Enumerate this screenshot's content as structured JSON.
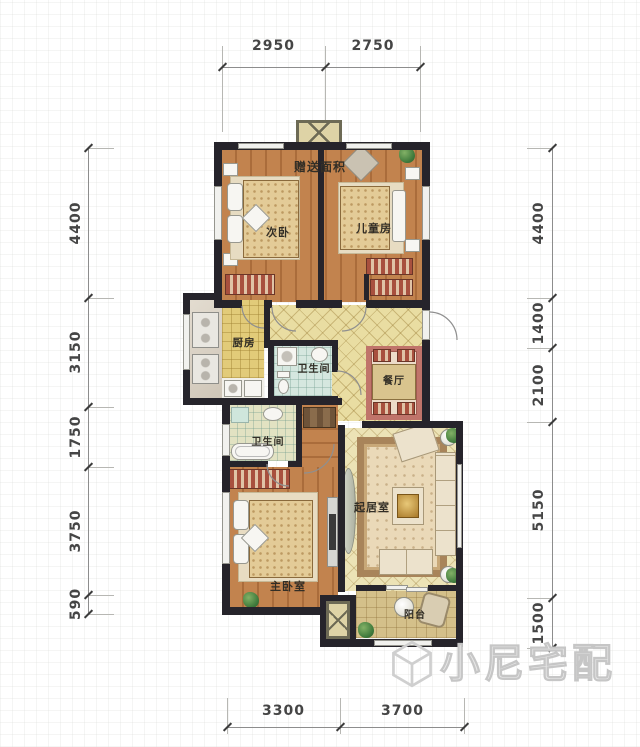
{
  "dimensions": {
    "top": [
      "2950",
      "2750"
    ],
    "bottom": [
      "3300",
      "3700"
    ],
    "left": [
      "4400",
      "3150",
      "1750",
      "3750",
      "590"
    ],
    "right": [
      "4400",
      "1400",
      "2100",
      "5150",
      "1500"
    ]
  },
  "rooms": {
    "bonus_area": {
      "label": "赠送面积"
    },
    "secondary_bedroom": {
      "label": "次卧"
    },
    "children_room": {
      "label": "儿童房"
    },
    "kitchen": {
      "label": "厨房"
    },
    "bathroom_upper": {
      "label": "卫生间"
    },
    "dining_room": {
      "label": "餐厅"
    },
    "bathroom_lower": {
      "label": "卫生间"
    },
    "master_bedroom": {
      "label": "主卧室"
    },
    "living_room": {
      "label": "起居室"
    },
    "balcony": {
      "label": "阳台"
    }
  },
  "watermark": {
    "text": "小尼宅配"
  },
  "colors": {
    "wall": "#26242b",
    "wood_floor": "#c2834e",
    "kitchen_floor": "#e2cb79",
    "hall_floor": "#e9dda2",
    "bath_tile": "#d5e7df",
    "balcony_floor": "#d4c08a",
    "dining_rug_border": "#c0746a",
    "living_rug": "#ead9b8",
    "dimension_text": "#454545"
  }
}
